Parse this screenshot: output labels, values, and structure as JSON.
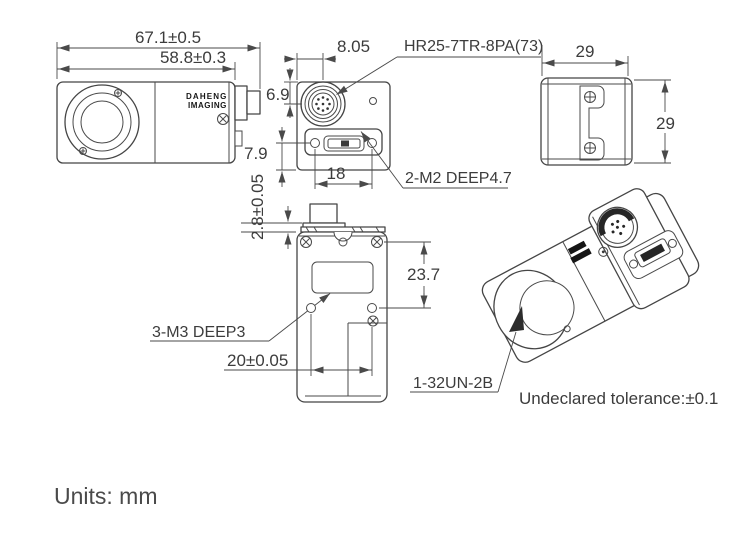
{
  "units_label": "Units: mm",
  "tolerance_note": "Undeclared tolerance:±0.1",
  "brand": {
    "line1": "DAHENG",
    "line2": "IMAGING"
  },
  "dimensions": {
    "outer_length": "67.1±0.5",
    "inner_length": "58.8±0.3",
    "connector_offset_x": "8.05",
    "connector_offset_y": "6.9",
    "sdr_offset_y": "7.9",
    "m2_spacing": "18",
    "flange_thickness": "2.8±0.05",
    "body_width": "29",
    "body_height": "29",
    "m3_offset_y": "23.7",
    "m3_spacing": "20±0.05"
  },
  "labels": {
    "hirose_connector": "HR25-7TR-8PA(73)",
    "m2_holes": "2-M2 DEEP4.7",
    "m3_holes": "3-M3 DEEP3",
    "lens_thread": "1-32UN-2B"
  }
}
